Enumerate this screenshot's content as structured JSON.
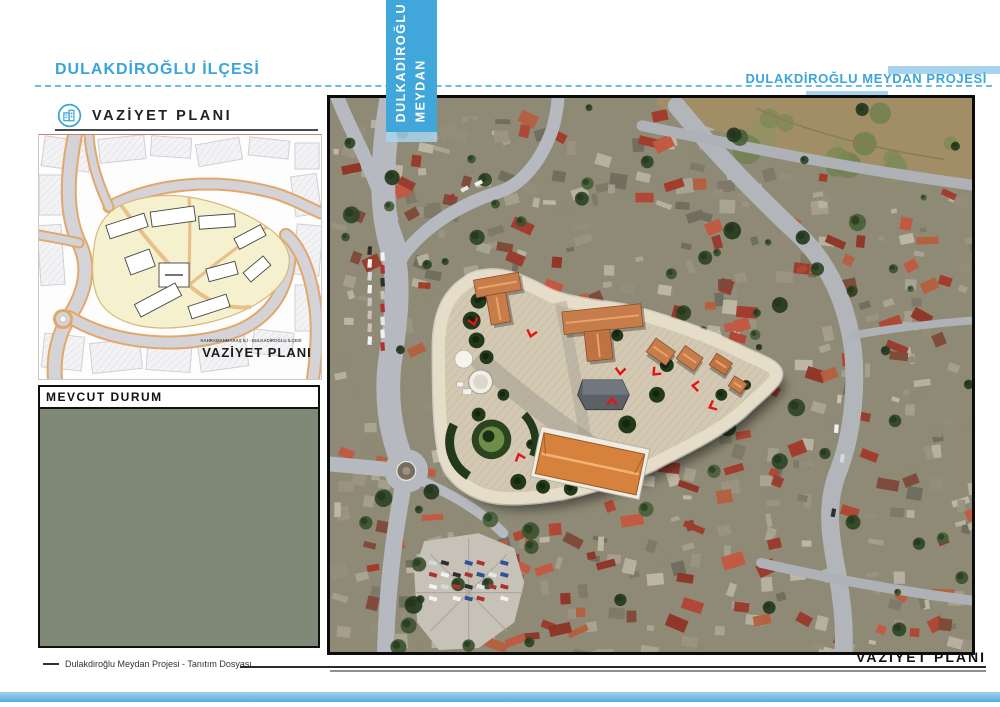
{
  "page": {
    "header_left": "DULAKDİROĞLU İLÇESİ",
    "header_right": "DULAKDİROĞLU MEYDAN PROJESİ",
    "banner_text": "DULKADİROĞLU\nMEYDAN",
    "footer_left": "Dulakdiroğlu Meydan Projesi - Tanıtım Dosyası",
    "footer_right": "VAZİYET PLANI"
  },
  "left_column": {
    "section_title": "VAZİYET PLANI",
    "map_caption_small": "KAHRAMANMARAŞ İLİ - DULKADİROĞLU İLÇESİ",
    "map_caption_large": "VAZİYET PLANI",
    "mevcut_title": "MEVCUT DURUM"
  },
  "icons": {
    "section_icon": "building-icon"
  },
  "colors": {
    "accent_blue": "#3AA5DA",
    "banner_blue": "#41A7DB",
    "light_blue": "#A7D4EC",
    "site_yellow_fill": "#F5F1CF",
    "highlight_yellow": "#E6E23C",
    "highlight_red": "#D42020",
    "marker_red": "#E41414",
    "roof_terracotta": "#C77C4B"
  }
}
